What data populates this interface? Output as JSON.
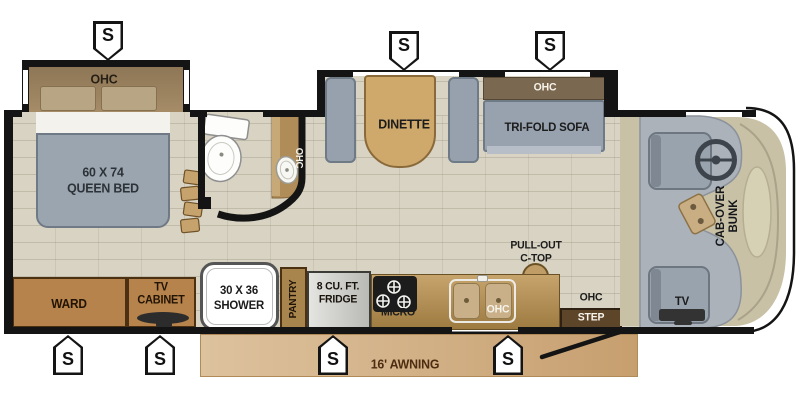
{
  "rooms": {
    "bedroom": {
      "ohc": "OHC",
      "bed_line1": "60 X 74",
      "bed_line2": "QUEEN BED"
    },
    "bathroom": {
      "ohc": "OHC"
    },
    "living": {
      "dinette": "DINETTE",
      "sofa_ohc": "OHC",
      "sofa": "TRI-FOLD SOFA"
    },
    "cab": {
      "bunk_line1": "CAB-OVER",
      "bunk_line2": "BUNK",
      "tv": "TV"
    },
    "kitchen": {
      "pantry": "PANTRY",
      "fridge_line1": "8 CU. FT.",
      "fridge_line2": "FRIDGE",
      "micro": "MICRO",
      "sink_ohc": "OHC",
      "pullout_line1": "PULL-OUT",
      "pullout_line2": "C-TOP"
    },
    "storage": {
      "ward": "WARD",
      "tv_cabinet_line1": "TV",
      "tv_cabinet_line2": "CABINET",
      "shower_line1": "30 X 36",
      "shower_line2": "SHOWER"
    },
    "entry": {
      "ohc": "OHC",
      "step": "STEP"
    },
    "exterior": {
      "awning": "16' AWNING"
    }
  },
  "slide_markers": [
    {
      "location": "bedroom-slide",
      "symbol": "S"
    },
    {
      "location": "dinette-slide",
      "symbol": "S"
    },
    {
      "location": "sofa-slide",
      "symbol": "S"
    },
    {
      "location": "ward-slide",
      "symbol": "S"
    },
    {
      "location": "tv-cabinet-slide",
      "symbol": "S"
    },
    {
      "location": "kitchen-slide-left",
      "symbol": "S"
    },
    {
      "location": "kitchen-slide-right",
      "symbol": "S"
    }
  ],
  "colors": {
    "wall": "#141414",
    "floor_tile": "#d8d3c3",
    "cabinet_wood": "#b5834b",
    "counter": "#b3905c",
    "seat_gray": "#98a2ae",
    "table_tan": "#cfa86b",
    "cab_floor": "#c8c1a6",
    "awning": "#d4b289",
    "shower_white": "#ffffff"
  }
}
